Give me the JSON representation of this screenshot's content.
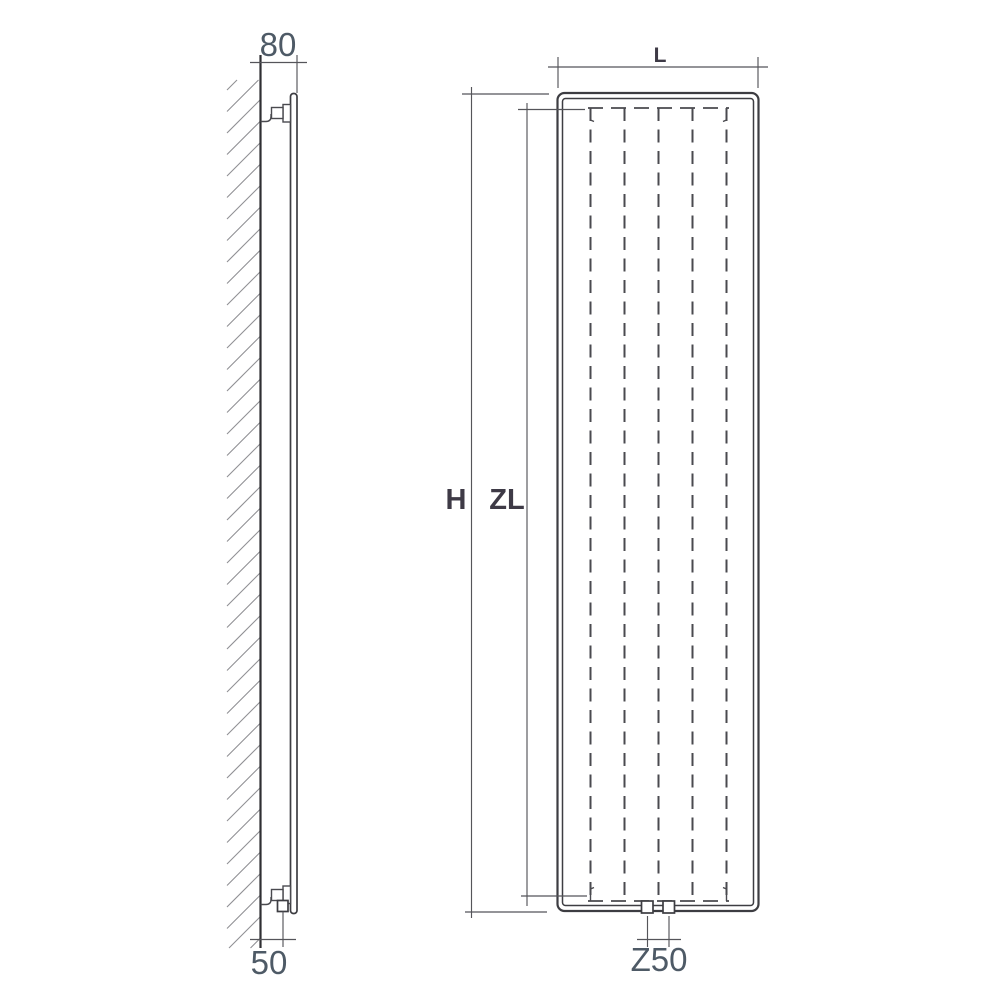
{
  "diagram": {
    "type": "technical-drawing",
    "subject": "vertical-panel-radiator-dimension-diagram",
    "labels": {
      "depth_top": "80",
      "pipe_offset_bottom": "50",
      "width": "L",
      "height": "H",
      "fin_height": "ZL",
      "connection_spacing": "Z50"
    },
    "colors": {
      "background": "#ffffff",
      "main_line": "#3d3d42",
      "dashed_line": "#4a4a4f",
      "hatch_line": "#8f8f93",
      "dimension_line": "#55555a",
      "number_text": "#4e5a66",
      "letter_text": "#3e3a46"
    }
  }
}
